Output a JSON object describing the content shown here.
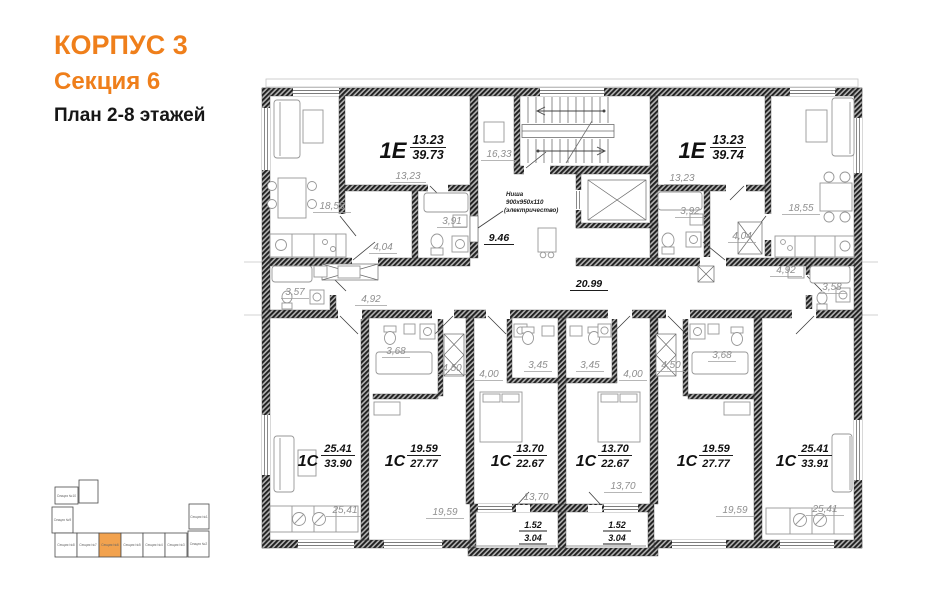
{
  "header": {
    "building": "КОРПУС 3",
    "section": "Секция 6",
    "plan": "План 2-8 этажей",
    "accent_color": "#ef7f1b"
  },
  "apartments": {
    "e_left": {
      "type": "1Е",
      "living": "13.23",
      "total": "39.73"
    },
    "e_right": {
      "type": "1Е",
      "living": "13.23",
      "total": "39.74"
    },
    "s1": {
      "type": "1С",
      "living": "25.41",
      "total": "33.90"
    },
    "s2": {
      "type": "1С",
      "living": "19.59",
      "total": "27.77"
    },
    "s3": {
      "type": "1С",
      "living": "13.70",
      "total": "22.67"
    },
    "s4": {
      "type": "1С",
      "living": "13.70",
      "total": "22.67"
    },
    "s5": {
      "type": "1С",
      "living": "19.59",
      "total": "27.77"
    },
    "s6": {
      "type": "1С",
      "living": "25.41",
      "total": "33.91"
    }
  },
  "rooms": {
    "living_left": "18,55",
    "bedroom_left": "13,23",
    "bath_left": "3,91",
    "hall_left": "4,04",
    "landing": "16,33",
    "lobby": "9.46",
    "corridor": "20.99",
    "bedroom_right": "13,23",
    "bath_right": "3,92",
    "hall_right": "4,04",
    "living_right": "18,55",
    "s1_bath": "3,57",
    "s1_hall": "4,92",
    "s6_hall": "4,92",
    "s6_bath": "3,58",
    "s2_bath": "3,68",
    "s2_hall": "4,50",
    "s3_hall": "4,00",
    "s3_bath": "3,45",
    "s4_bath": "3,45",
    "s4_hall": "4,00",
    "s5_hall": "4,50",
    "s5_bath": "3,68",
    "s1_room": "25,41",
    "s2_room": "19,59",
    "s3_room": "13,70",
    "s4_room": "13,70",
    "s5_room": "19,59",
    "s6_room": "25,41",
    "balcony1_area": "1.52",
    "balcony1_total": "3.04",
    "balcony2_area": "1.52",
    "balcony2_total": "3.04"
  },
  "niche": {
    "line1": "Ниша",
    "line2": "900х950х110",
    "line3": "(электричество)"
  },
  "keyplan": {
    "highlight_color": "#f2a24e",
    "sections": [
      {
        "label": "Секция №10",
        "highlight": false
      },
      {
        "label": "Секция №9",
        "highlight": false
      },
      {
        "label": "Секция №8",
        "highlight": false
      },
      {
        "label": "Секция №7",
        "highlight": false
      },
      {
        "label": "Секция №6",
        "highlight": true
      },
      {
        "label": "Секция №5",
        "highlight": false
      },
      {
        "label": "Секция №4",
        "highlight": false
      },
      {
        "label": "Секция №3",
        "highlight": false
      },
      {
        "label": "Секция №2",
        "highlight": false
      },
      {
        "label": "Секция №1",
        "highlight": false
      }
    ]
  }
}
